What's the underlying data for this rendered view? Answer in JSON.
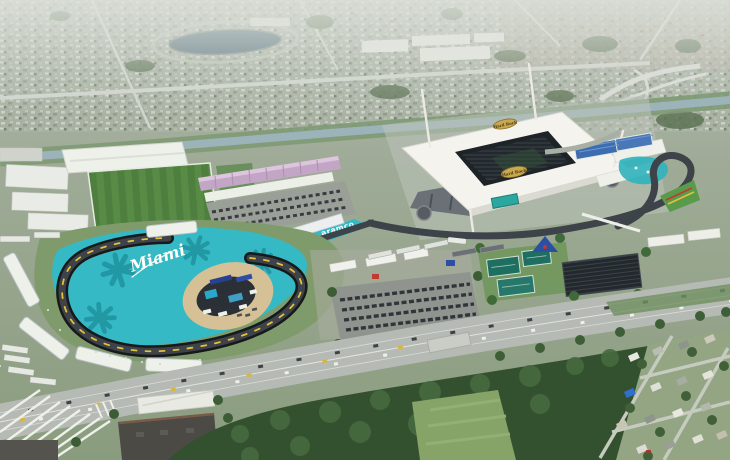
{
  "meta": {
    "type": "aerial-photograph",
    "subject": "Hard Rock Stadium and the Miami International Autodrome race circuit, Miami Gardens, Florida"
  },
  "labels": {
    "track_script": "Miami",
    "runoff_sponsor": "aramco",
    "stadium_logo": "Hard Rock"
  },
  "palette": {
    "runoff_teal": "#35b9c4",
    "palm_teal": "#1f93a0",
    "asphalt": "#3d4348",
    "kerb_black": "#17191c",
    "kerb_yellow": "#e2c23b",
    "stadium_roof": "#f4f3ee",
    "stadium_bowl": "#1d2327",
    "logo_gold": "#c9a94e",
    "grandstand_pink": "#c3a6c6",
    "practice_field_green": "#4e7f3e",
    "tree_green": "#33512f",
    "highway_gray": "#b6bab4",
    "canal_blue": "#9db3ba",
    "beach_sand": "#d6c196",
    "stand_blue": "#3c6db0",
    "scoreboard_teal": "#2aa8a0"
  }
}
